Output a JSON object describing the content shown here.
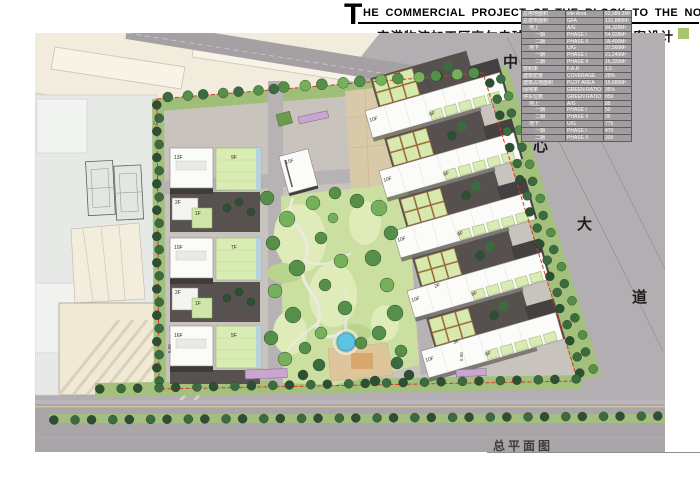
{
  "header": {
    "title_initial": "T",
    "title": "HE COMMERCIAL PROJECT OF THE BLOCK TO THE NORTH OF GOLF COURSE",
    "subtitle": "空港物流加工区高尔夫球场北侧商务地块方案设计"
  },
  "stats_table": {
    "rows": [
      {
        "cn": "总用地面积",
        "en": "site Area",
        "value": "62,989.3M²",
        "indent": 0
      },
      {
        "cn": "总建筑面积",
        "en": "GFA",
        "value": "131,888M²",
        "indent": 0
      },
      {
        "cn": "地上",
        "en": "A/G",
        "value": "94,328M²",
        "indent": 1
      },
      {
        "cn": "一期",
        "en": "PHASE I",
        "value": "54,928M²",
        "indent": 2
      },
      {
        "cn": "二期",
        "en": "PHASE II",
        "value": "39,400M²",
        "indent": 2
      },
      {
        "cn": "地下",
        "en": "U/G",
        "value": "37,560M²",
        "indent": 1
      },
      {
        "cn": "一期",
        "en": "PHASE I",
        "value": "21,240M²",
        "indent": 2
      },
      {
        "cn": "二期",
        "en": "PHASE II",
        "value": "16,320M²",
        "indent": 2
      },
      {
        "cn": "容积率",
        "en": "F.A.R",
        "value": "1.5",
        "indent": 0
      },
      {
        "cn": "建筑密度",
        "en": "COVERAGE",
        "value": "25%",
        "indent": 0
      },
      {
        "cn": "建筑占地面积",
        "en": "PLOT AREA",
        "value": "15,680M²",
        "indent": 0
      },
      {
        "cn": "绿地率",
        "en": "GREEN RATIO",
        "value": "35%",
        "indent": 0
      },
      {
        "cn": "停车位数",
        "en": "GREEN RATIO",
        "value": "850",
        "indent": 0
      },
      {
        "cn": "地上",
        "en": "A/G",
        "value": "85",
        "indent": 1
      },
      {
        "cn": "一期",
        "en": "PHASE I",
        "value": "50",
        "indent": 2
      },
      {
        "cn": "二期",
        "en": "PHASE II",
        "value": "35",
        "indent": 2
      },
      {
        "cn": "地下",
        "en": "U/G",
        "value": "775",
        "indent": 1
      },
      {
        "cn": "一期",
        "en": "PHASE I",
        "value": "470",
        "indent": 2
      },
      {
        "cn": "二期",
        "en": "PHASE II",
        "value": "305",
        "indent": 2
      }
    ]
  },
  "plan": {
    "label": "总平面图",
    "road_name": [
      "中",
      "心",
      "大",
      "道"
    ],
    "left_clusters": [
      {
        "tower": "13F",
        "podium": "9F",
        "cell_a": "2F",
        "cell_b": "1F"
      },
      {
        "tower": "10F",
        "podium": "7F",
        "cell_a": "2F",
        "cell_b": "1F"
      },
      {
        "tower": "16F",
        "podium": "5F",
        "cell_a": "2F",
        "cell_b": "1F"
      }
    ],
    "center_tower": "15F",
    "right_slabs": [
      {
        "tower": "10F",
        "podium": "6F"
      },
      {
        "tower": "10F",
        "podium": "6F"
      },
      {
        "tower": "10F",
        "podium": "6F"
      },
      {
        "tower": "10F",
        "podium": "6F"
      },
      {
        "tower": "10F",
        "podium": "6F"
      }
    ],
    "right_cells": [
      "3F",
      "2F"
    ],
    "dims": [
      "15.00",
      "15.00",
      "5.00",
      "5.00"
    ]
  },
  "colors": {
    "accent_green": "#a9c76a",
    "road_gray": "#b3aeb1",
    "park_green": "#cbe0a0",
    "pond_blue": "#5fc3e6",
    "boundary_red": "#e03423"
  }
}
